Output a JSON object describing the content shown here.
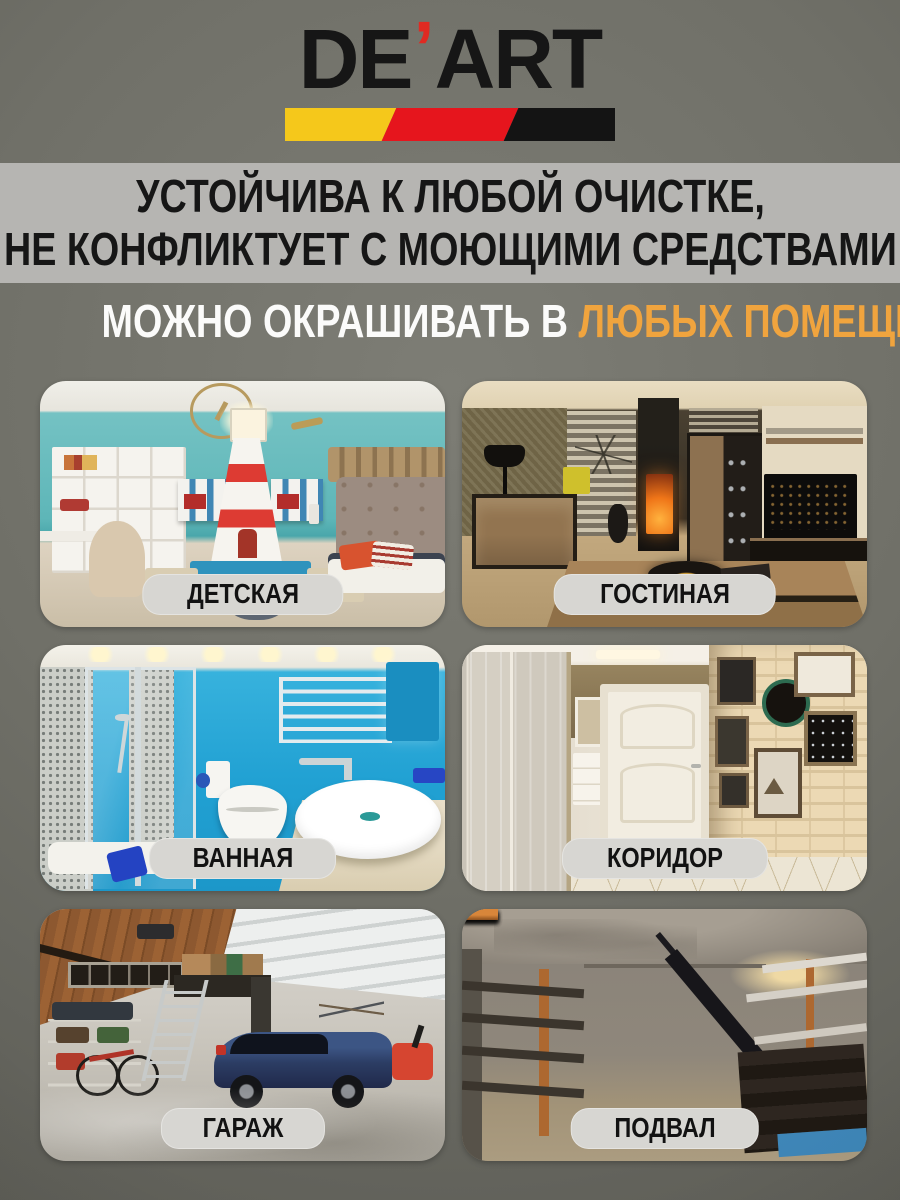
{
  "brand": {
    "logo_prefix": "DE",
    "logo_apostrophe": "’",
    "logo_suffix": "ART",
    "apostrophe_color": "#E02A22",
    "stripe_colors": [
      "#F5C81B",
      "#E6151D",
      "#141414"
    ]
  },
  "headline": {
    "line1": "УСТОЙЧИВА К ЛЮБОЙ ОЧИСТКЕ,",
    "line2": "НЕ КОНФЛИКТУЕТ С МОЮЩИМИ СРЕДСТВАМИ"
  },
  "claim": {
    "prefix": "МОЖНО ОКРАШИВАТЬ В ",
    "highlight": "ЛЮБЫХ ПОМЕЩЕНИЯХ",
    "highlight_color": "#F0A43E"
  },
  "rooms": [
    {
      "label": "ДЕТСКАЯ"
    },
    {
      "label": "ГОСТИНАЯ"
    },
    {
      "label": "ВАННАЯ"
    },
    {
      "label": "КОРИДОР"
    },
    {
      "label": "ГАРАЖ"
    },
    {
      "label": "ПОДВАЛ"
    }
  ]
}
